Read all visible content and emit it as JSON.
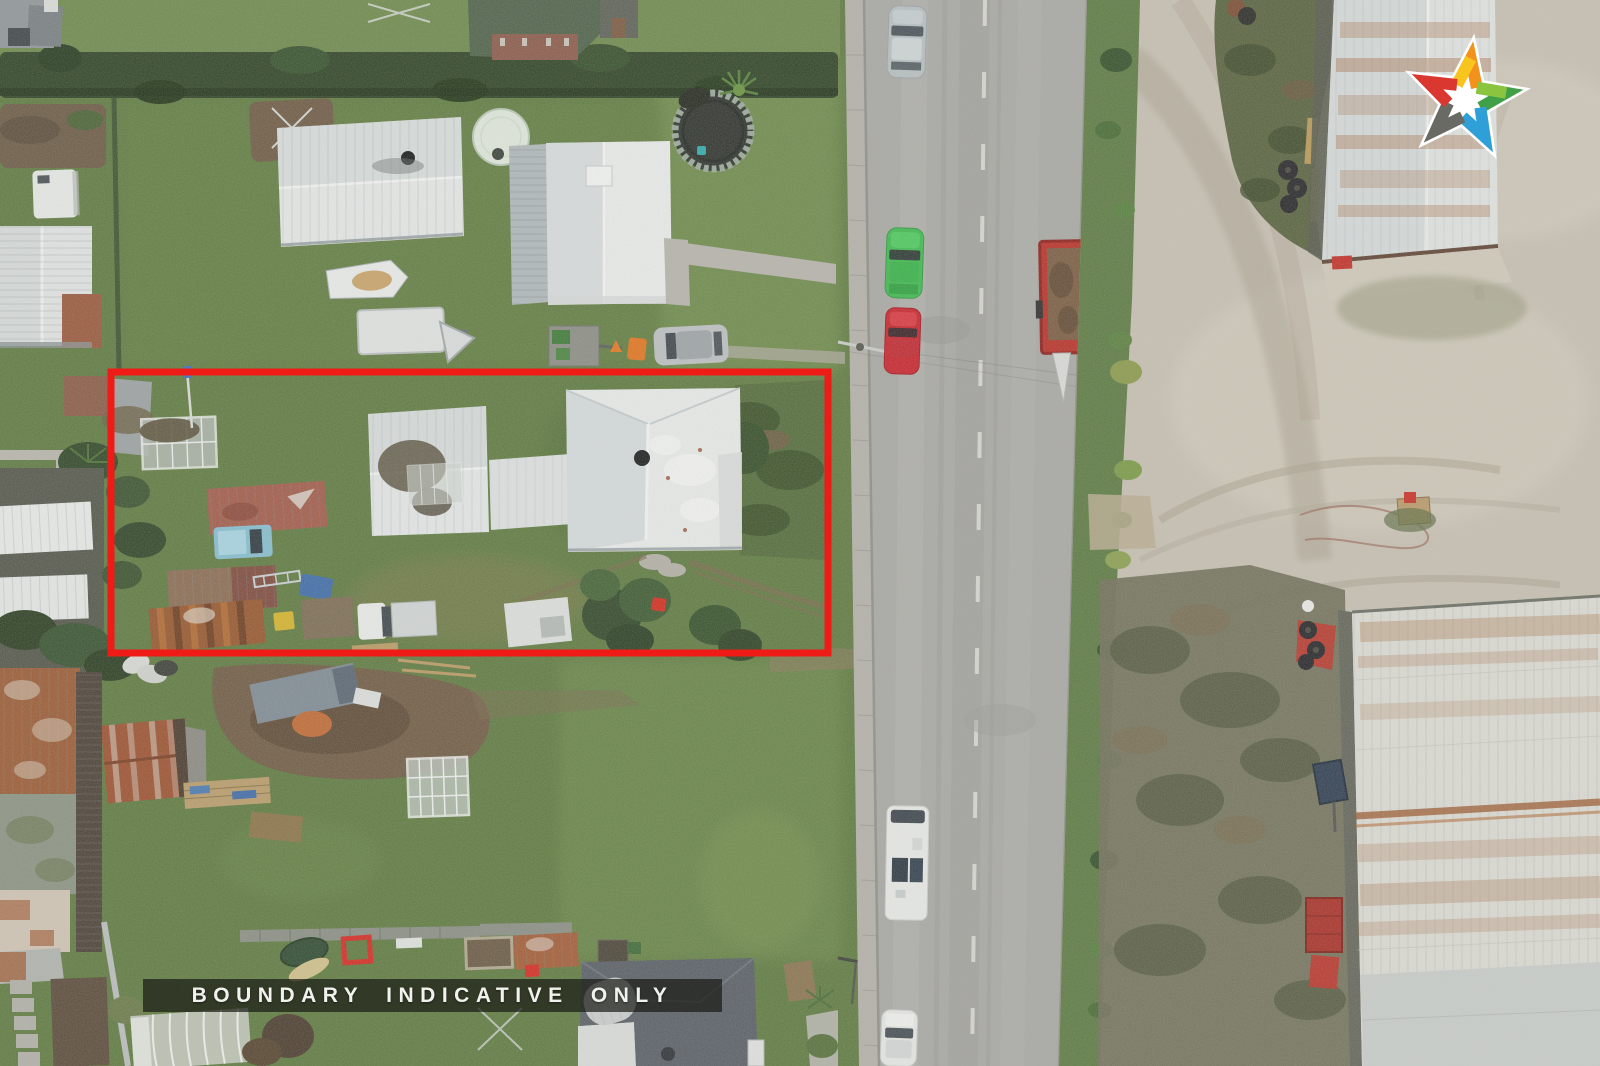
{
  "photo": {
    "kind": "aerial-drone-photograph",
    "palette": {
      "grass_left": "#5e7a40",
      "road": "#a8a8a4",
      "gravel": "#c6c0b2",
      "road_verge": "#5c7a42",
      "hedge": "#2e4326"
    }
  },
  "boundary": {
    "label": "BOUNDARY INDICATIVE ONLY",
    "color": "#ee1b17",
    "bar_style": "background:rgba(24,26,20,0.70)"
  },
  "logo": {
    "icon": "five-chevron-star-icon",
    "colors": {
      "red": "#d9372f",
      "orange": "#f2921d",
      "yellow": "#f8c51e",
      "green": "#3fa047",
      "green_light": "#8bc540",
      "blue": "#2f9fd8",
      "gray": "#696a64"
    }
  }
}
